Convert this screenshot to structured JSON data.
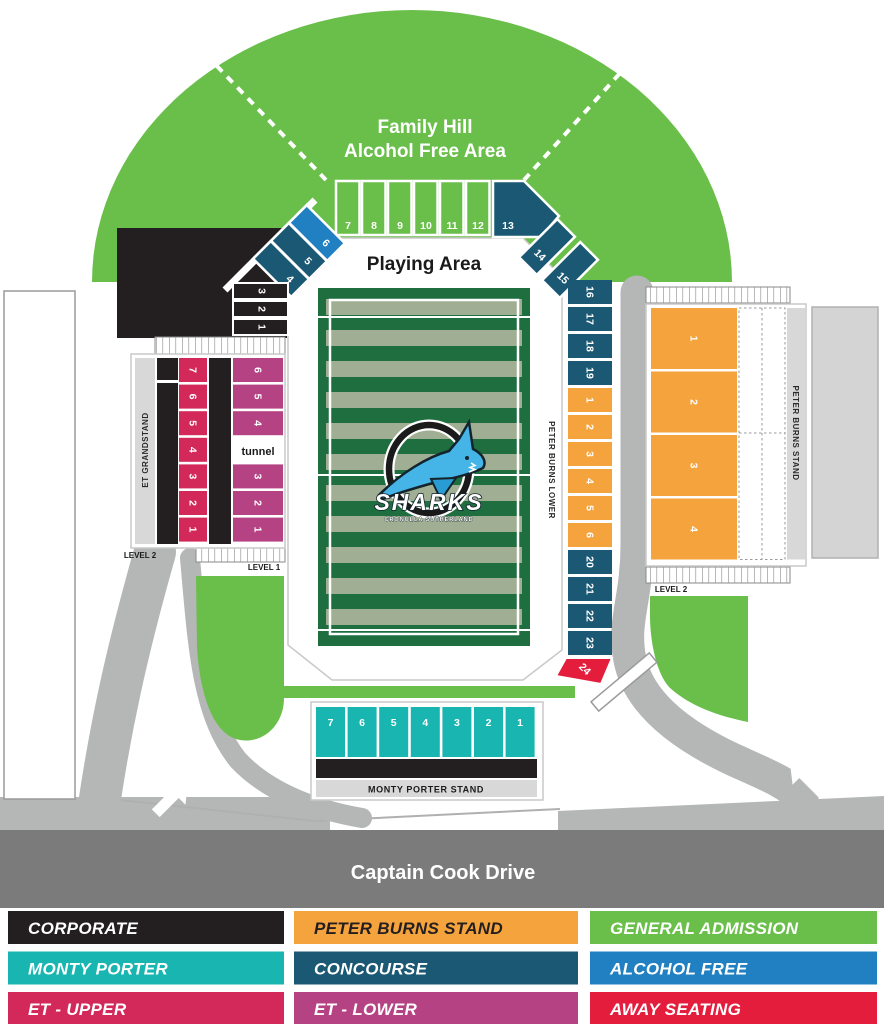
{
  "map": {
    "hill": {
      "line1": "Family Hill",
      "line2": "Alcohol Free Area"
    },
    "playing_area_label": "Playing Area",
    "logo": {
      "team": "SHARKS",
      "sub": "CRONULLA   SUTHERLAND"
    },
    "labels": {
      "et_grandstand": "ET GRANDSTAND",
      "peter_burns_stand": "PETER BURNS STAND",
      "peter_burns_lower": "PETER BURNS LOWER",
      "monty_porter_stand": "MONTY PORTER STAND",
      "level_1": "LEVEL 1",
      "level_2_left": "LEVEL 2",
      "level_2_right": "LEVEL 2",
      "tunnel": "tunnel",
      "captain_cook_drive": "Captain Cook Drive"
    },
    "sections": {
      "corporate_rows": [
        "3",
        "2",
        "1"
      ],
      "diag_left": [
        "4",
        "5",
        "6"
      ],
      "hill_row": [
        "7",
        "8",
        "9",
        "10",
        "11",
        "12"
      ],
      "corner": "13",
      "diag_right": [
        "14",
        "15"
      ],
      "concourse_upper_right": [
        "16",
        "17",
        "18",
        "19"
      ],
      "peter_burns_lower_rows": [
        "1",
        "2",
        "3",
        "4",
        "5",
        "6"
      ],
      "concourse_lower_right": [
        "20",
        "21",
        "22",
        "23"
      ],
      "away": "24",
      "et_upper_rows": [
        "7",
        "6",
        "5",
        "4",
        "3",
        "2",
        "1"
      ],
      "et_lower_top_rows": [
        "6",
        "5",
        "4"
      ],
      "et_lower_bottom_rows": [
        "3",
        "2",
        "1"
      ],
      "peter_burns_stand_rows": [
        "1",
        "2",
        "3",
        "4"
      ],
      "monty_porter_row": [
        "7",
        "6",
        "5",
        "4",
        "3",
        "2",
        "1"
      ]
    },
    "colors": {
      "general_admission_green": "#6abf4b",
      "concourse_teal": "#1b5873",
      "alcohol_free_blue": "#2180c2",
      "monty_porter_teal": "#18b5b1",
      "et_upper_crimson": "#d2285a",
      "et_lower_magenta": "#b54384",
      "peter_burns_orange": "#f5a33c",
      "away_red": "#e41d3d",
      "corporate_black": "#231f20",
      "field_dark_green": "#1e6e3f",
      "field_sage": "#a0af94",
      "road_light_gray": "#b5b6b6",
      "road_dark_gray": "#7b7b7c"
    }
  },
  "legend": {
    "items": [
      {
        "label": "CORPORATE",
        "bg": "#231f20",
        "fg": "#ffffff"
      },
      {
        "label": "PETER BURNS STAND",
        "bg": "#f5a33c",
        "fg": "#231f20"
      },
      {
        "label": "GENERAL ADMISSION",
        "bg": "#6abf4b",
        "fg": "#ffffff"
      },
      {
        "label": "MONTY PORTER",
        "bg": "#18b5b1",
        "fg": "#ffffff"
      },
      {
        "label": "CONCOURSE",
        "bg": "#1b5873",
        "fg": "#ffffff"
      },
      {
        "label": "ALCOHOL FREE",
        "bg": "#2180c2",
        "fg": "#ffffff"
      },
      {
        "label": "ET - UPPER",
        "bg": "#d2285a",
        "fg": "#ffffff"
      },
      {
        "label": "ET - LOWER",
        "bg": "#b54384",
        "fg": "#ffffff"
      },
      {
        "label": "AWAY SEATING",
        "bg": "#e41d3d",
        "fg": "#ffffff"
      }
    ]
  }
}
